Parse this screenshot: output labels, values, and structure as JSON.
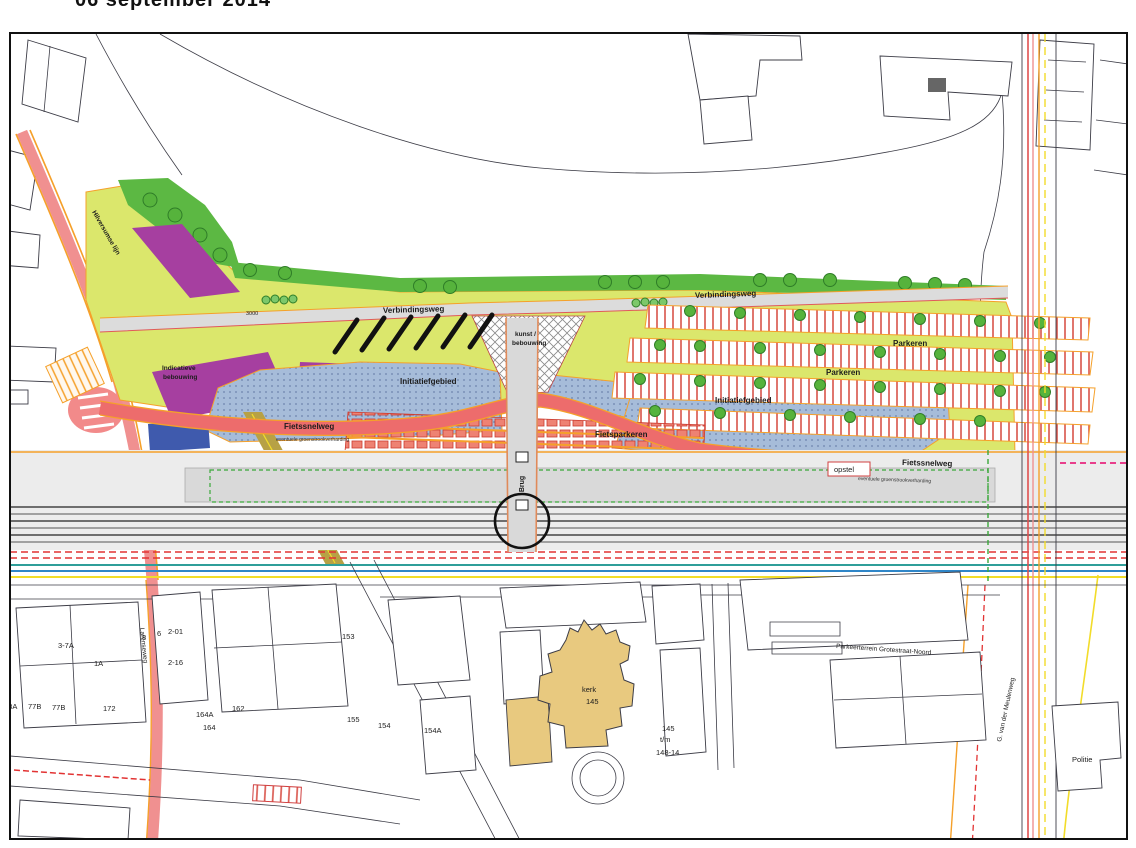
{
  "title": {
    "date_note": "06 september 2014"
  },
  "map": {
    "labels": {
      "verbindingsweg_left": "Verbindingsweg",
      "verbindingsweg_right": "Verbindingsweg",
      "dim_3000": "3000",
      "kunst_1": "kunst /",
      "kunst_2": "bebouwing",
      "parkeren_1": "Parkeren",
      "parkeren_2": "Parkeren",
      "initiatiefgebied_left": "Initiatiefgebied",
      "initiatiefgebied_right": "Initiatiefgebied",
      "indicatieve_1": "Indicatieve",
      "indicatieve_2": "bebouwing",
      "fietssnelweg_left": "Fietssnelweg",
      "fietssnelweg_right": "Fietssnelweg",
      "subtext_left": "eventuele groenstrookverharding",
      "subtext_right": "eventuele groenstrookverharding",
      "fietsparkeren": "Fietsparkeren",
      "brug": "Brug",
      "opstel": "opstel",
      "spoorlijn": "Hilversumse lijn",
      "straat_links": "Larenseweg",
      "straat_rechts": "G. van der Meulenweg",
      "parkeerterrein": "Parkeerterrein Grotestraat-Noord",
      "politie": "Politie",
      "kerk": "kerk",
      "kerk_nr": "145"
    },
    "huisnummers": {
      "n8": "8",
      "n6": "6",
      "n2_01": "2-01",
      "n2_16": "2-16",
      "n3_7a": "3-7A",
      "n1a": "1A",
      "n78a": "78A",
      "n77b_1": "77B",
      "n77b_2": "77B",
      "n172": "172",
      "n153": "153",
      "n155": "155",
      "n154": "154",
      "n154a": "154A",
      "n164a": "164A",
      "n164": "164",
      "n162": "162",
      "n145": "145",
      "ntm": "t/m",
      "n148_14": "148-14"
    },
    "colors": {
      "plan_yellow": "#dbe76c",
      "green_band": "#5cb843",
      "purple": "#a63fa0",
      "blue_area": "#a6bcd9",
      "red_route": "#ed6c6c",
      "orange": "#f5a02a",
      "stall_red": "#d9534a",
      "navy": "#3f5aad",
      "beige": "#e8c97f",
      "tan": "#b7a145",
      "road_gray": "#dcdcdc",
      "teal": "#2f9e99",
      "cyan": "#2f86c8",
      "yellow_line": "#f2dc2a",
      "magenta": "#e83e8c"
    }
  }
}
